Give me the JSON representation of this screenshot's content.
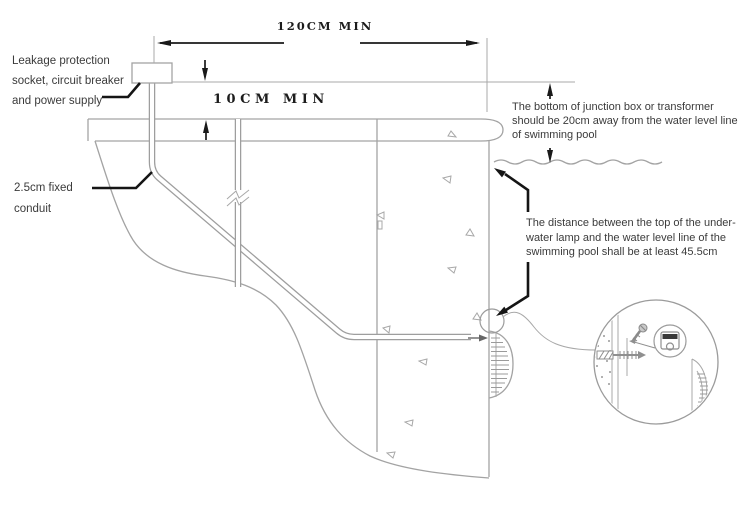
{
  "diagram": {
    "subject": "swimming-pool-underwater-lamp-installation-section"
  },
  "annotations": {
    "leakage_label": {
      "lines": [
        "Leakage protection",
        "socket, circuit breaker",
        "and power supply"
      ]
    },
    "conduit_label": {
      "lines": [
        "2.5cm fixed",
        "conduit"
      ]
    },
    "junction_box_note": {
      "lines": [
        "The bottom of junction box or transformer",
        "should be 20cm away from the water level line",
        "of swimming pool"
      ]
    },
    "lamp_note": {
      "lines": [
        "The distance between the top of the under-",
        "water lamp and the water level line of the",
        "swimming pool shall be at least 45.5cm"
      ]
    }
  },
  "dimensions": {
    "horizontal_clearance": "120CM MIN",
    "burial_depth": "10CM MIN"
  },
  "colors": {
    "background": "#ffffff",
    "drawing_line": "#a3a3a3",
    "annotation_line": "#151515",
    "text": "#3b3b3b"
  }
}
